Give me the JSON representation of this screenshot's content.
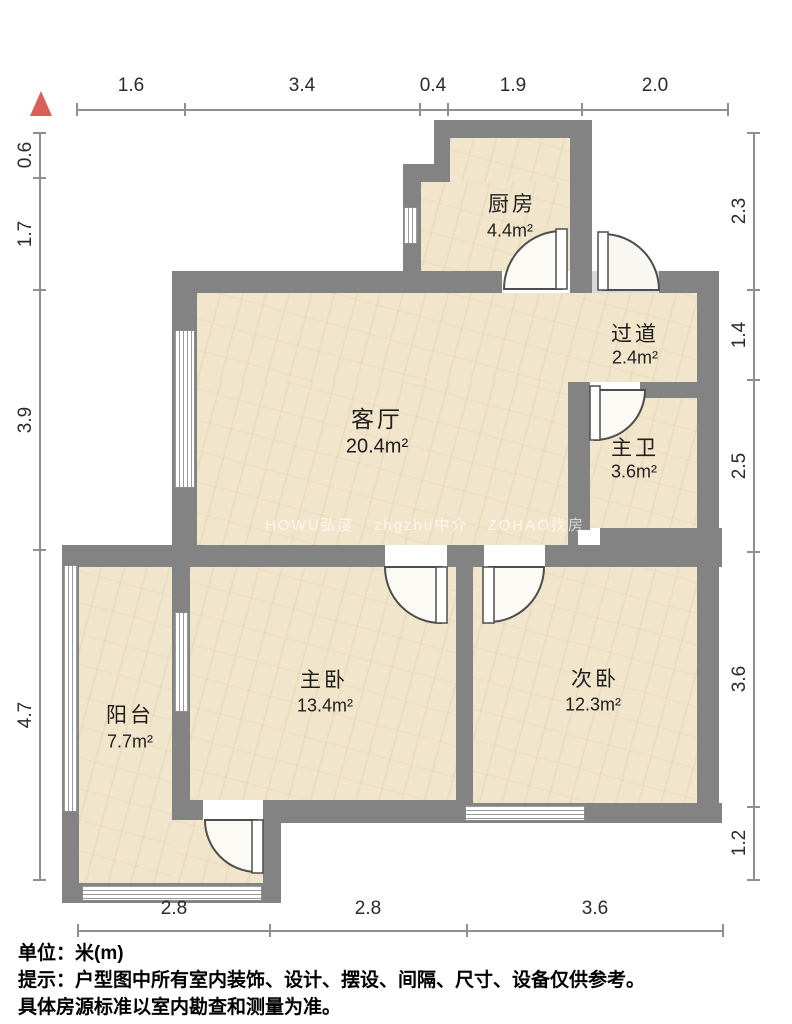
{
  "title": "户型图",
  "rooms": {
    "kitchen": {
      "name": "厨房",
      "area": "4.4m²"
    },
    "hallway": {
      "name": "过道",
      "area": "2.4m²"
    },
    "living": {
      "name": "客厅",
      "area": "20.4m²"
    },
    "bath": {
      "name": "主卫",
      "area": "3.6m²"
    },
    "master": {
      "name": "主卧",
      "area": "13.4m²"
    },
    "second": {
      "name": "次卧",
      "area": "12.3m²"
    },
    "balcony": {
      "name": "阳台",
      "area": "7.7m²"
    }
  },
  "dims": {
    "top": [
      "1.6",
      "3.4",
      "0.4",
      "1.9",
      "2.0"
    ],
    "left": [
      "0.6",
      "1.7",
      "3.9",
      "4.7"
    ],
    "right": [
      "2.3",
      "1.4",
      "2.5",
      "3.6",
      "1.2"
    ],
    "bottom": [
      "2.8",
      "2.8",
      "3.6"
    ]
  },
  "watermark": "HOWU弘度 · zhgzhu中介 · ZOHAO找房",
  "footer": {
    "unit": "单位：米(m)",
    "tip1": "提示：户型图中所有室内装饰、设计、摆设、间隔、尺寸、设备仅供参考。",
    "tip2": "具体房源标准以室内勘查和测量为准。"
  },
  "colors": {
    "wall": "#838383",
    "floor": "#f1e5cc",
    "north_arrow": "#d95f57",
    "dim_line": "#8f8f8f"
  }
}
